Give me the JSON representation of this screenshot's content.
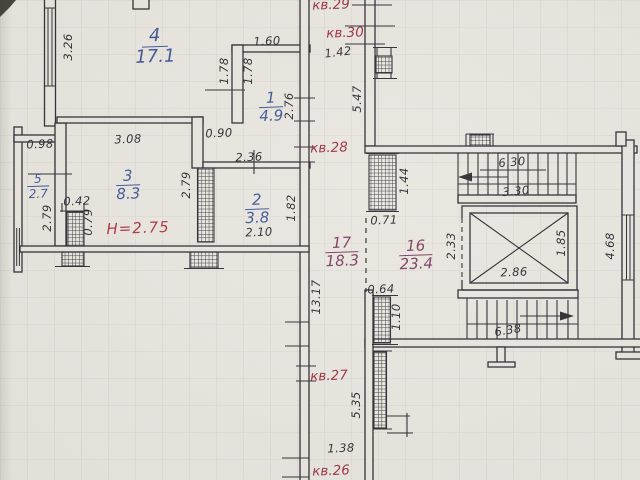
{
  "document": {
    "kind": "scanned floor plan",
    "height_note": "H=2.75"
  },
  "colors": {
    "paper": "#e9e6e0",
    "grid": "#d8d4cc",
    "ink": "#2e2d33",
    "room_number_blue": "#3d5795",
    "room_number_purple": "#7d3e60",
    "apartment_red": "#9d3242",
    "note_red": "#b13343"
  },
  "rooms": [
    {
      "number": "4",
      "area": "17.1"
    },
    {
      "number": "1",
      "area": "4.9"
    },
    {
      "number": "5",
      "area": "2.7"
    },
    {
      "number": "3",
      "area": "8.3"
    },
    {
      "number": "2",
      "area": "3.8"
    },
    {
      "number": "17",
      "area": "18.3"
    },
    {
      "number": "16",
      "area": "23.4"
    }
  ],
  "apartments": {
    "kv29": "кв.29",
    "kv30": "кв.30",
    "kv28": "кв.28",
    "kv27": "кв.27",
    "kv26": "кв.26"
  },
  "dims": [
    "3.26",
    "1.60",
    "1.78",
    "1.78",
    "2.76",
    "0.90",
    "3.08",
    "2.36",
    "0.98",
    "2.79",
    "0.42",
    "0.79",
    "2.79",
    "1.82",
    "2.10",
    "13.17",
    "1.42",
    "5.47",
    "1.44",
    "0.71",
    "0.64",
    "1.10",
    "2.33",
    "6.30",
    "3.30",
    "2.86",
    "1.85",
    "4.68",
    "6.38",
    "5.35",
    "1.38"
  ]
}
